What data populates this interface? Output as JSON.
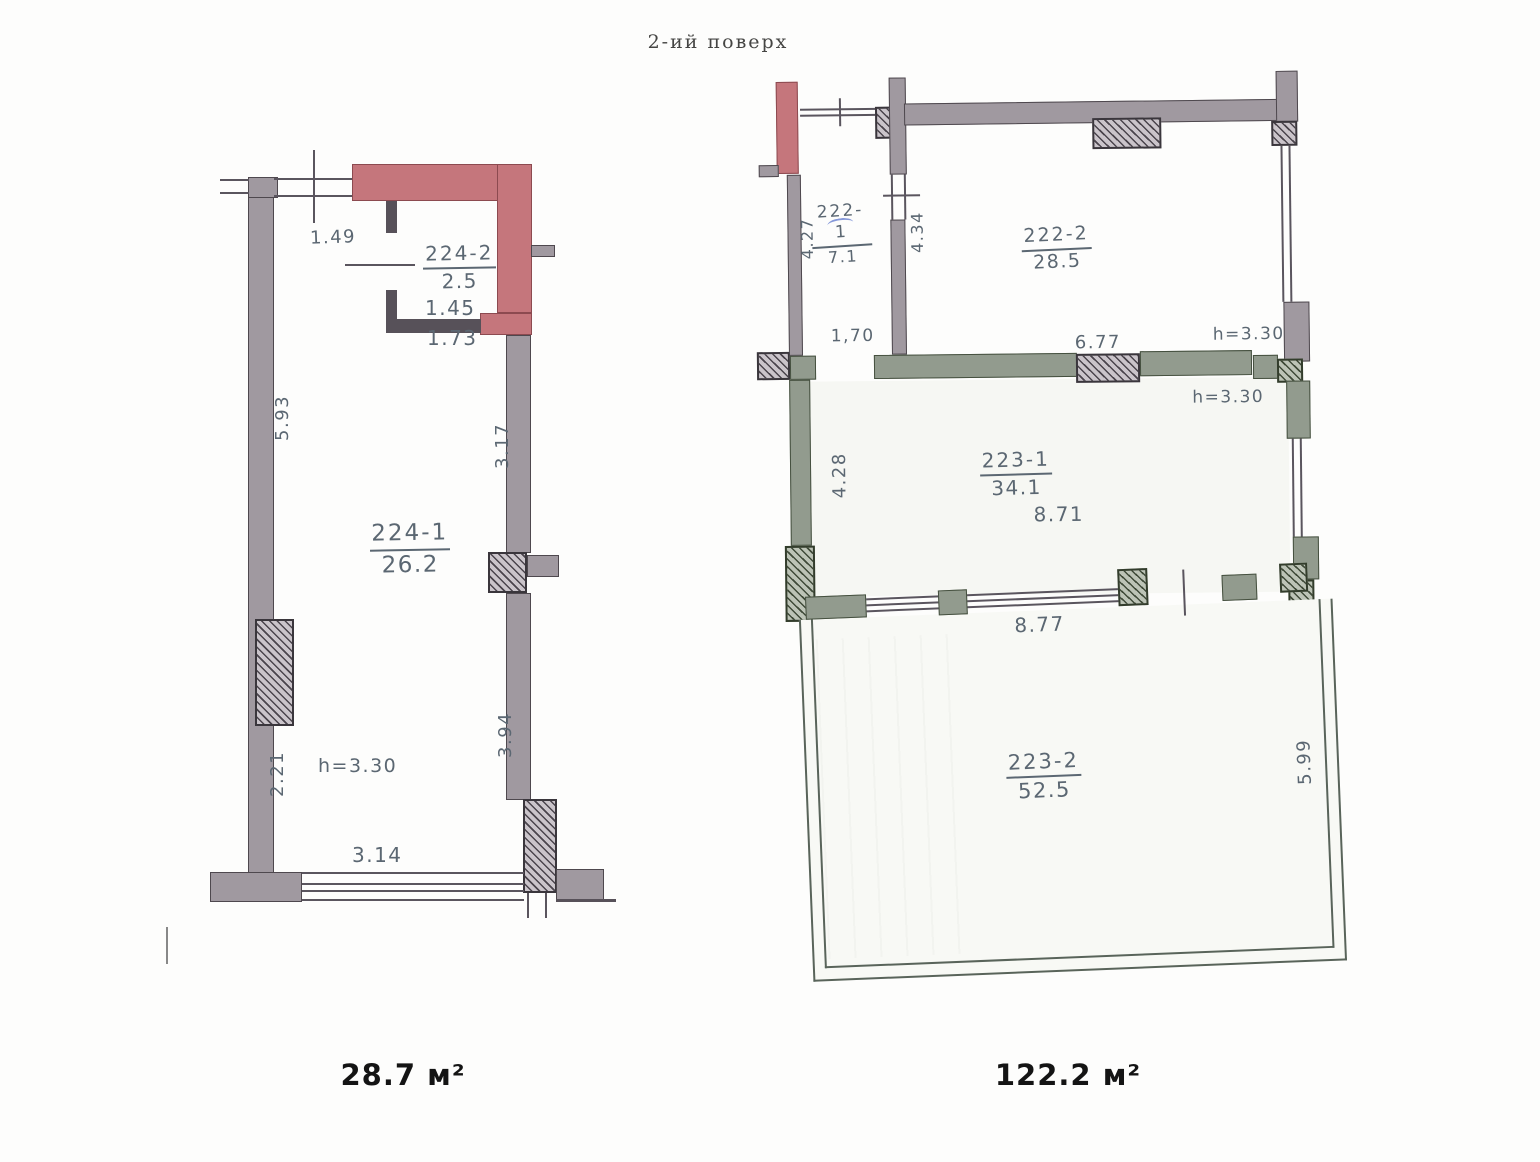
{
  "title": "2-ий  поверх",
  "colors": {
    "highlight_wall": "#c5767c",
    "wall_gray": "#a099a0",
    "wall_green_gray": "#929b8e",
    "dimension_text": "#5b6772"
  },
  "left_plan": {
    "total_area": "28.7 м²",
    "rooms": {
      "r224_2": {
        "id": "224-2",
        "area": "2.5"
      },
      "r224_1": {
        "id": "224-1",
        "area": "26.2"
      }
    },
    "dims": {
      "w_top": "1.49",
      "w_inner": "1.45",
      "w_outer": "1.73",
      "h_left_upper": "5.93",
      "h_right_upper": "3.17",
      "h_right_lower": "3.94",
      "h_left_lower": "2.21",
      "w_bottom": "3.14",
      "ceiling": "h=3.30"
    }
  },
  "right_plan": {
    "total_area": "122.2 м²",
    "rooms": {
      "r222_1": {
        "id": "222-1",
        "area": "7.1"
      },
      "r222_2": {
        "id": "222-2",
        "area": "28.5"
      },
      "r223_1": {
        "id": "223-1",
        "area": "34.1"
      },
      "r223_2": {
        "id": "223-2",
        "area": "52.5"
      }
    },
    "dims": {
      "h_222_1_left": "4.27",
      "h_222_1_right": "4.34",
      "door_width": "1,70",
      "w_222_2_bottom": "6.77",
      "ceiling_222": "h=3.30",
      "h_223_1_left": "4.28",
      "w_223_1": "8.71",
      "ceiling_223": "h=3.30",
      "w_223_2_top": "8.77",
      "h_223_2_right": "5.99"
    }
  }
}
